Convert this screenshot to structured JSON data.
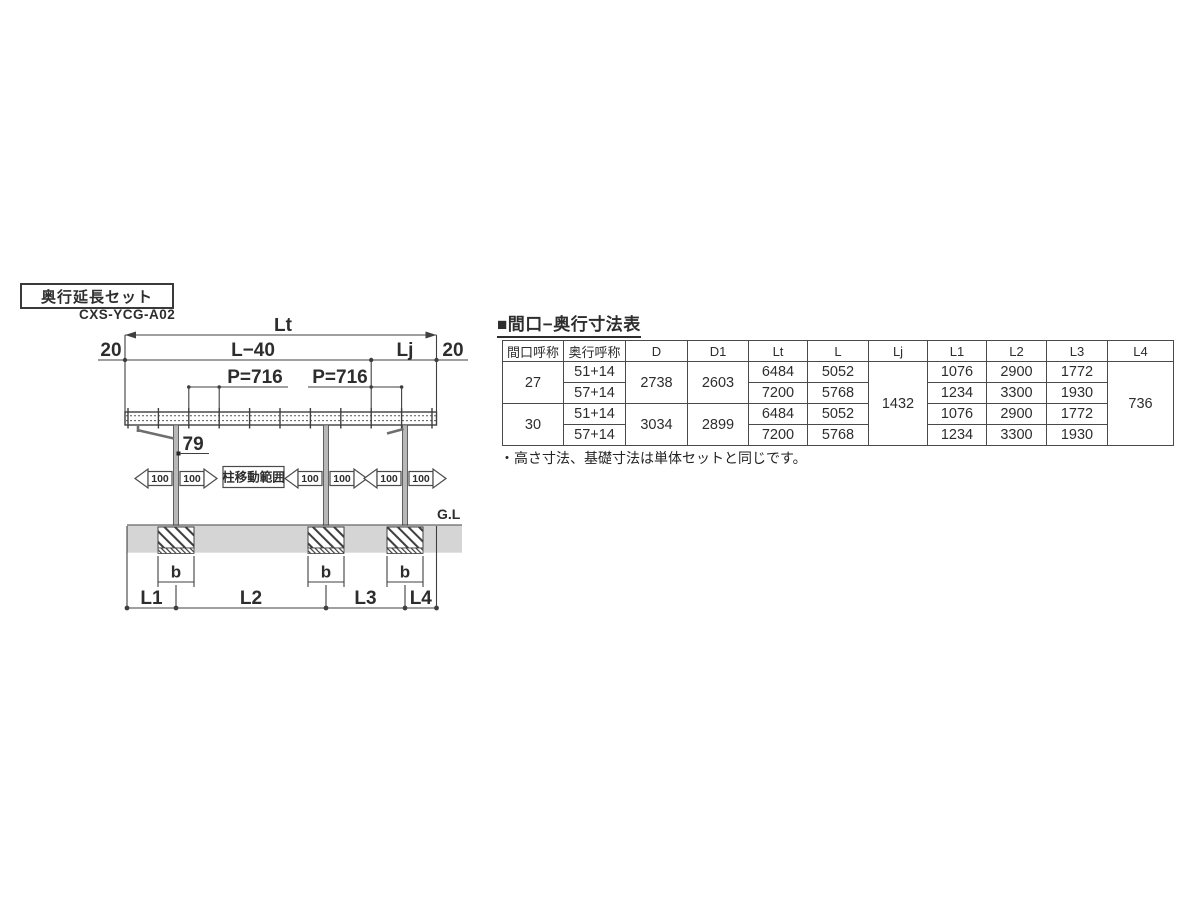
{
  "colors": {
    "line": "#3f3f3f",
    "ground_band": "#d5d5d5",
    "column_fill": "#b8b8b8",
    "text": "#2d2d2d"
  },
  "diagram": {
    "set_label": "奥行延長セット",
    "model_code": "CXS-YCG-A02",
    "dims": {
      "lt": "Lt",
      "left20": "20",
      "l40": "L−40",
      "lj": "Lj",
      "right20": "20",
      "p1": "P=716",
      "p2": "P=716",
      "d79": "79",
      "move_100": "100",
      "move_range": "柱移動範囲",
      "gl": "G.L",
      "b": "b",
      "l1": "L1",
      "l2": "L2",
      "l3": "L3",
      "l4": "L4"
    }
  },
  "table": {
    "title": "■間口−奥行寸法表",
    "headers": [
      "間口呼称",
      "奥行呼称",
      "D",
      "D1",
      "Lt",
      "L",
      "Lj",
      "L1",
      "L2",
      "L3",
      "L4"
    ],
    "lj": "1432",
    "l4": "736",
    "groups": [
      {
        "maguchi": "27",
        "d": "2738",
        "d1": "2603",
        "rows": [
          {
            "okuyuki": "51+14",
            "lt": "6484",
            "l": "5052",
            "l1": "1076",
            "l2": "2900",
            "l3": "1772"
          },
          {
            "okuyuki": "57+14",
            "lt": "7200",
            "l": "5768",
            "l1": "1234",
            "l2": "3300",
            "l3": "1930"
          }
        ]
      },
      {
        "maguchi": "30",
        "d": "3034",
        "d1": "2899",
        "rows": [
          {
            "okuyuki": "51+14",
            "lt": "6484",
            "l": "5052",
            "l1": "1076",
            "l2": "2900",
            "l3": "1772"
          },
          {
            "okuyuki": "57+14",
            "lt": "7200",
            "l": "5768",
            "l1": "1234",
            "l2": "3300",
            "l3": "1930"
          }
        ]
      }
    ],
    "note": "・高さ寸法、基礎寸法は単体セットと同じです。"
  }
}
